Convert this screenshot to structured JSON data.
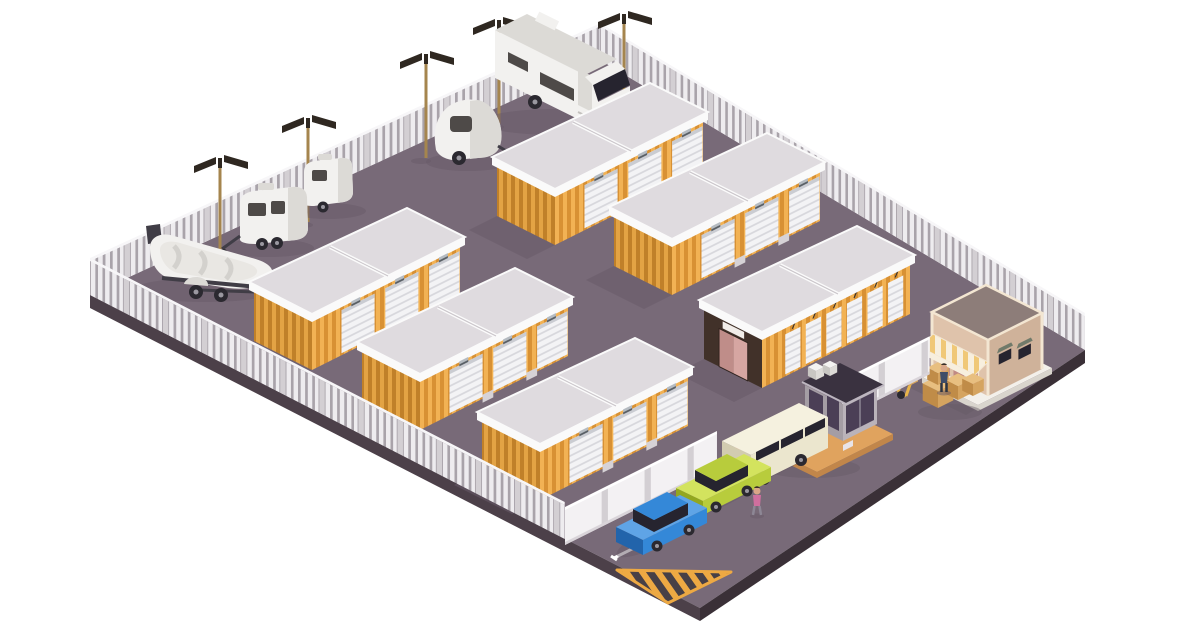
{
  "scene": {
    "description": "Isometric illustration of a self-storage facility: rows of yellow storage unit buildings with white roller doors, an RV and boat parking area behind a picket fence, a security booth with barrier gate, an office entrance building with striped awning, parked cars, moving boxes, a hand truck and hazard striping on the pavement.",
    "title": "Self-storage facility isometric illustration"
  },
  "inventory": {
    "storage_buildings": {
      "count": 5,
      "roller_doors_each": 3,
      "wall": "yellow corrugated",
      "roof": "flat light gray with white trim"
    },
    "drive_up_building": {
      "count": 1,
      "narrow_roller_doors": 6,
      "end_face": "dark brown with pink double doors and blank sign"
    },
    "office_building": {
      "count": 1,
      "features": [
        "striped awning",
        "pink entry doors",
        "two vented windows",
        "flat dark roof",
        "white pad"
      ]
    },
    "security_booth": {
      "count": 1,
      "features": [
        "dark windows",
        "rooftop AC unit",
        "orange platform",
        "striped barrier arm"
      ]
    },
    "vehicles": [
      "white RV motorhome",
      "teardrop camper trailer",
      "small caravan trailer",
      "large caravan trailer",
      "boat on trailer",
      "blue hatchback",
      "lime green sedan",
      "beige van"
    ],
    "light_poles": 5,
    "people": 2,
    "moving_boxes": 5,
    "hand_truck": 1,
    "hazard_triangle": 1,
    "parking_space_markers": 3,
    "fences": [
      "white picket perimeter fence (3 edges)",
      "solid white inner wall with gate gap"
    ]
  },
  "colors": {
    "bg": "#ffffff",
    "ground": "#786a78",
    "shadow": "#675a67",
    "slab-sw": "#4c4049",
    "slab-se": "#3a3037",
    "fence-light": "#eeecef",
    "fence-mid": "#a9a3aa",
    "fence-post": "#d3cfd3",
    "fence-rail": "#f7f6f8",
    "y1": "#f2b254",
    "y2": "#d89134",
    "y1d": "#e3a344",
    "y2d": "#c08029",
    "roof-top": "#dfdbdf",
    "roof-white": "#fafafa",
    "roof-seam": "#c9c4c9",
    "door-white": "#f3f3f5",
    "door-slat": "#d8d8dd",
    "door-lintel": "#caccd2",
    "step": "#d6d2d6",
    "lamp": "#b5bbc1",
    "lamp-dark": "#5a6066",
    "dark-face": "#413129",
    "pink1": "#d6a6a2",
    "pink2": "#bf8d89",
    "sign": "#f1ede9",
    "office-sw": "#dfc3ab",
    "office-se": "#cfb29a",
    "office-roof": "#8d7d79",
    "office-trim": "#f3e6d2",
    "awn1": "#f7efde",
    "awn2": "#f0c877",
    "office-door": "#c08a84",
    "office-base": "#f3f0ea",
    "office-base-side": "#d9d5cd",
    "win-cap": "#707a6a",
    "booth-w1": "#a49da4",
    "booth-w2": "#bab3ba",
    "booth-win": "#4b3f56",
    "booth-frame": "#8d8694",
    "booth-roof": "#3a3240",
    "booth-base": "#e0a35e",
    "booth-base-side": "#c1864a",
    "barrier-red": "#d95454",
    "car-blue": "#3488d8",
    "car-blue-dark": "#2264ab",
    "car-blue-light": "#5fa4e6",
    "car-green": "#b8cc3c",
    "car-green-dark": "#93a71f",
    "car-green-light": "#d3e35e",
    "van-body": "#ebe6ce",
    "van-dark": "#d2ccb0",
    "van-light": "#f5f1df",
    "glass": "#26242f",
    "white-body": "#f2f1ef",
    "white-shade": "#dcdad6",
    "white-dark": "#c3c1bd",
    "win-dark": "#4e4a48",
    "pole": "#a5854e",
    "panel": "#2f2821",
    "box-top": "#e8bf80",
    "box-side": "#d5a460",
    "box-front": "#c08c48",
    "hz-orange": "#eda943",
    "hz-dark": "#474046",
    "trailer-dark": "#403d46",
    "wheel": "#2b2930",
    "hub": "#9a98a0",
    "boat-deck": "#e9e7e3",
    "boat-seat": "#d3d1cd",
    "skin": "#d9a687",
    "hair": "#3a2f28",
    "person-a-top": "#3e4d68",
    "person-a-leg": "#2c3442",
    "person-b-top": "#cf6f9e",
    "person-b-leg": "#8d8795",
    "parking-line": "#ffffff"
  }
}
